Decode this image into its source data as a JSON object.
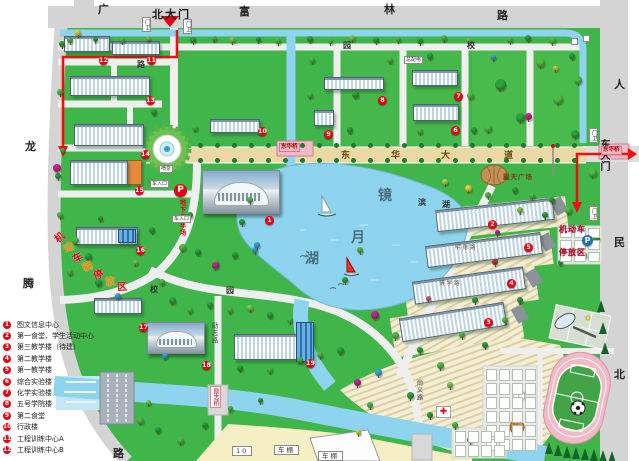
{
  "gates": {
    "north": "北大门",
    "east": "东大门"
  },
  "plaza": {
    "name": "露天广场"
  },
  "parking": {
    "underground": {
      "p": "P",
      "name": "地下停车场"
    },
    "motor": {
      "p": "P",
      "line1": "机动车",
      "line2": "停放区"
    }
  },
  "icons": {
    "medical_cross": "✚"
  },
  "zone_arc": {
    "text": "机动车辆停放区",
    "chars": [
      {
        "t": "机",
        "x": 54,
        "y": 229,
        "r": -40,
        "c": "#e60012"
      },
      {
        "t": "动",
        "x": 63,
        "y": 239,
        "r": -34,
        "c": "#f08300"
      },
      {
        "t": "车",
        "x": 72,
        "y": 249,
        "r": -28,
        "c": "#e60012"
      },
      {
        "t": "辆",
        "x": 82,
        "y": 258,
        "r": -22,
        "c": "#f08300"
      },
      {
        "t": "停",
        "x": 93,
        "y": 266,
        "r": -16,
        "c": "#e60012"
      },
      {
        "t": "放",
        "x": 105,
        "y": 273,
        "r": -10,
        "c": "#f08300"
      },
      {
        "t": "区",
        "x": 117,
        "y": 278,
        "r": -4,
        "c": "#e60012"
      }
    ]
  },
  "lake": {
    "chars": [
      {
        "t": "镜",
        "x": 378,
        "y": 185
      },
      {
        "t": "月",
        "x": 351,
        "y": 227
      },
      {
        "t": "湖",
        "x": 305,
        "y": 248
      }
    ]
  },
  "bridges": [
    {
      "name": "东华桥",
      "x": 279,
      "y": 143
    },
    {
      "name": "东华桥",
      "x": 601,
      "y": 146
    }
  ],
  "legend": {
    "items": [
      {
        "num": "1",
        "label": "图文信息中心"
      },
      {
        "num": "2",
        "label": "第一食堂、学生活动中心"
      },
      {
        "num": "3",
        "label": "第三教学楼（待建）"
      },
      {
        "num": "4",
        "label": "第二教学楼"
      },
      {
        "num": "5",
        "label": "第一教学楼"
      },
      {
        "num": "6",
        "label": "综合实验楼"
      },
      {
        "num": "7",
        "label": "化学实验楼"
      },
      {
        "num": "8",
        "label": "五号学院楼"
      },
      {
        "num": "9",
        "label": "第二食堂"
      },
      {
        "num": "10",
        "label": "行政楼"
      },
      {
        "num": "11",
        "label": "工程训练中心A"
      },
      {
        "num": "12",
        "label": "工程训练中心B"
      }
    ]
  },
  "markers": {
    "circles": [
      {
        "n": "1",
        "x": 265,
        "y": 216
      },
      {
        "n": "2",
        "x": 488,
        "y": 220
      },
      {
        "n": "3",
        "x": 484,
        "y": 318
      },
      {
        "n": "4",
        "x": 507,
        "y": 279
      },
      {
        "n": "5",
        "x": 524,
        "y": 243
      },
      {
        "n": "6",
        "x": 451,
        "y": 126
      },
      {
        "n": "7",
        "x": 454,
        "y": 92
      },
      {
        "n": "8",
        "x": 378,
        "y": 96
      },
      {
        "n": "9",
        "x": 324,
        "y": 130
      },
      {
        "n": "10",
        "x": 258,
        "y": 127
      },
      {
        "n": "11",
        "x": 147,
        "y": 56
      },
      {
        "n": "12",
        "x": 99,
        "y": 56
      },
      {
        "n": "13",
        "x": 146,
        "y": 96
      },
      {
        "n": "14",
        "x": 141,
        "y": 150
      },
      {
        "n": "15",
        "x": 135,
        "y": 186
      },
      {
        "n": "16",
        "x": 136,
        "y": 246
      },
      {
        "n": "17",
        "x": 139,
        "y": 323
      },
      {
        "n": "18",
        "x": 202,
        "y": 361
      },
      {
        "n": "19",
        "x": 306,
        "y": 359
      }
    ]
  },
  "road_chars": [
    {
      "t": "广",
      "x": 98,
      "y": 1,
      "cls": "big"
    },
    {
      "t": "富",
      "x": 239,
      "y": 3,
      "cls": "big"
    },
    {
      "t": "林",
      "x": 384,
      "y": 1,
      "cls": "big"
    },
    {
      "t": "路",
      "x": 497,
      "y": 7,
      "cls": "big"
    },
    {
      "t": "人",
      "x": 614,
      "y": 76,
      "cls": "big"
    },
    {
      "t": "民",
      "x": 614,
      "y": 234,
      "cls": "big"
    },
    {
      "t": "北",
      "x": 614,
      "y": 366,
      "cls": "big"
    },
    {
      "t": "龙",
      "x": 25,
      "y": 138,
      "cls": "big"
    },
    {
      "t": "腾",
      "x": 23,
      "y": 275,
      "cls": "big"
    },
    {
      "t": "路",
      "x": 113,
      "y": 445,
      "cls": "big"
    },
    {
      "t": "园",
      "x": 343,
      "y": 40,
      "cls": "small"
    },
    {
      "t": "校",
      "x": 467,
      "y": 40,
      "cls": "small"
    },
    {
      "t": "路",
      "x": 137,
      "y": 59,
      "cls": "small"
    },
    {
      "t": "校",
      "x": 150,
      "y": 284,
      "cls": "small"
    },
    {
      "t": "园",
      "x": 226,
      "y": 285,
      "cls": "small"
    },
    {
      "t": "滨",
      "x": 418,
      "y": 197,
      "cls": "small"
    },
    {
      "t": "湖",
      "x": 442,
      "y": 199,
      "cls": "small"
    },
    {
      "t": "东",
      "x": 341,
      "y": 148,
      "cls": "blvd"
    },
    {
      "t": "华",
      "x": 391,
      "y": 148,
      "cls": "blvd"
    },
    {
      "t": "大",
      "x": 441,
      "y": 148,
      "cls": "blvd"
    },
    {
      "t": "道",
      "x": 504,
      "y": 148,
      "cls": "blvd"
    },
    {
      "t": "励志路",
      "x": 209,
      "y": 322,
      "cls": "vert"
    },
    {
      "t": "励志桥",
      "x": 210,
      "y": 386,
      "cls": "vertred"
    },
    {
      "t": "尚义路",
      "x": 414,
      "y": 379,
      "cls": "vert"
    },
    {
      "t": "明德路",
      "x": 455,
      "y": 243,
      "cls": "tinypath"
    },
    {
      "t": "博学路",
      "x": 439,
      "y": 279,
      "cls": "tinypath"
    }
  ],
  "boxes": [
    {
      "t": "门卫",
      "x": 142,
      "y": 17,
      "vert": true
    },
    {
      "t": "门卫",
      "x": 183,
      "y": 19,
      "vert": true
    },
    {
      "t": "门卫",
      "x": 589,
      "y": 128,
      "vert": true
    },
    {
      "t": "门卫",
      "x": 589,
      "y": 206,
      "vert": true
    },
    {
      "t": "车入口",
      "x": 150,
      "y": 180
    },
    {
      "t": "车入口",
      "x": 172,
      "y": 215
    },
    {
      "t": "总配电",
      "x": 404,
      "y": 56
    },
    {
      "t": "喷泉",
      "x": 159,
      "y": 165
    },
    {
      "t": "",
      "x": 571,
      "y": 38
    },
    {
      "t": "",
      "x": 583,
      "y": 35
    },
    {
      "t": "10",
      "x": 232,
      "y": 446,
      "wide": true
    },
    {
      "t": "车棚",
      "x": 274,
      "y": 445,
      "wide": true
    },
    {
      "t": "车棚",
      "x": 318,
      "y": 451,
      "wide": true
    }
  ],
  "colors": {
    "grass": "#3fb54a",
    "water": "#8fd4ee",
    "road": "#d4d4d4",
    "inner_road": "#efefef",
    "boulevard": "#ead9a5",
    "sand": "#f6efc3",
    "marker_red": "#e60012",
    "route_red": "#f01010",
    "track_pink": "#f3b9c4",
    "field_green": "#43a447"
  },
  "decor": {
    "tree_palette": [
      "#17862f",
      "#2ea33c",
      "#4fbd45",
      "#7bcf52",
      "#a9dc4e",
      "#e3cf3a",
      "#c2268e",
      "#7e2b95",
      "#36a6da",
      "#d4608a",
      "#b23737"
    ],
    "trees": [
      [
        70,
        40,
        6,
        2
      ],
      [
        78,
        33,
        6,
        5
      ],
      [
        95,
        39,
        5,
        1
      ],
      [
        122,
        40,
        6,
        2
      ],
      [
        148,
        38,
        5,
        3
      ],
      [
        193,
        40,
        6,
        1
      ],
      [
        214,
        38,
        5,
        2
      ],
      [
        232,
        40,
        6,
        3
      ],
      [
        258,
        39,
        5,
        1
      ],
      [
        278,
        41,
        6,
        2
      ],
      [
        310,
        39,
        6,
        1
      ],
      [
        330,
        41,
        5,
        2
      ],
      [
        352,
        38,
        6,
        3
      ],
      [
        376,
        40,
        6,
        1
      ],
      [
        398,
        39,
        5,
        2
      ],
      [
        420,
        41,
        6,
        1
      ],
      [
        444,
        38,
        6,
        2
      ],
      [
        468,
        40,
        5,
        3
      ],
      [
        493,
        57,
        5,
        8
      ],
      [
        510,
        40,
        6,
        2
      ],
      [
        528,
        38,
        6,
        1
      ],
      [
        552,
        40,
        7,
        2
      ],
      [
        572,
        56,
        6,
        1
      ],
      [
        500,
        84,
        11,
        1
      ],
      [
        540,
        62,
        9,
        2
      ],
      [
        520,
        117,
        9,
        1
      ],
      [
        558,
        99,
        10,
        2
      ],
      [
        575,
        134,
        8,
        1
      ],
      [
        488,
        128,
        8,
        2
      ],
      [
        555,
        68,
        5,
        5
      ],
      [
        528,
        116,
        7,
        6
      ],
      [
        578,
        80,
        8,
        2
      ],
      [
        592,
        172,
        9,
        2
      ],
      [
        312,
        60,
        6,
        2
      ],
      [
        355,
        94,
        7,
        1
      ],
      [
        390,
        60,
        6,
        2
      ],
      [
        430,
        56,
        6,
        1
      ],
      [
        470,
        95,
        7,
        2
      ],
      [
        474,
        130,
        6,
        1
      ],
      [
        420,
        131,
        6,
        2
      ],
      [
        350,
        130,
        6,
        1
      ],
      [
        310,
        95,
        6,
        2
      ],
      [
        62,
        44,
        6,
        1
      ],
      [
        60,
        92,
        6,
        2
      ],
      [
        154,
        112,
        6,
        1
      ],
      [
        62,
        150,
        5,
        2
      ],
      [
        58,
        176,
        6,
        1
      ],
      [
        150,
        180,
        5,
        2
      ],
      [
        60,
        215,
        6,
        2
      ],
      [
        100,
        218,
        5,
        1
      ],
      [
        75,
        240,
        7,
        2
      ],
      [
        88,
        256,
        7,
        1
      ],
      [
        70,
        272,
        6,
        2
      ],
      [
        98,
        282,
        7,
        1
      ],
      [
        118,
        296,
        6,
        8
      ],
      [
        135,
        262,
        5,
        3
      ],
      [
        195,
        128,
        6,
        2
      ],
      [
        190,
        215,
        6,
        1
      ],
      [
        182,
        247,
        7,
        2
      ],
      [
        198,
        252,
        6,
        1
      ],
      [
        215,
        262,
        7,
        2
      ],
      [
        235,
        255,
        6,
        1
      ],
      [
        255,
        250,
        6,
        8
      ],
      [
        57,
        168,
        8,
        6
      ],
      [
        152,
        230,
        6,
        1
      ],
      [
        250,
        200,
        6,
        2
      ],
      [
        242,
        222,
        6,
        1
      ],
      [
        257,
        245,
        6,
        8
      ],
      [
        215,
        265,
        7,
        6
      ],
      [
        162,
        282,
        6,
        2
      ],
      [
        172,
        300,
        7,
        1
      ],
      [
        190,
        310,
        6,
        2
      ],
      [
        210,
        305,
        6,
        1
      ],
      [
        230,
        310,
        6,
        2
      ],
      [
        250,
        308,
        6,
        3
      ],
      [
        270,
        315,
        6,
        1
      ],
      [
        290,
        320,
        6,
        2
      ],
      [
        445,
        182,
        6,
        4
      ],
      [
        468,
        188,
        7,
        5
      ],
      [
        488,
        195,
        6,
        2
      ],
      [
        515,
        190,
        6,
        1
      ],
      [
        532,
        196,
        6,
        2
      ],
      [
        552,
        200,
        6,
        1
      ],
      [
        568,
        210,
        7,
        2
      ],
      [
        545,
        215,
        6,
        1
      ],
      [
        520,
        210,
        6,
        3
      ],
      [
        584,
        255,
        6,
        2
      ],
      [
        560,
        262,
        5,
        1
      ],
      [
        596,
        238,
        7,
        1
      ],
      [
        375,
        315,
        8,
        6
      ],
      [
        378,
        372,
        7,
        8
      ],
      [
        357,
        382,
        7,
        6
      ],
      [
        340,
        350,
        7,
        1
      ],
      [
        320,
        355,
        6,
        2
      ],
      [
        360,
        250,
        6,
        2
      ],
      [
        345,
        280,
        6,
        1
      ],
      [
        395,
        335,
        7,
        2
      ],
      [
        420,
        350,
        6,
        1
      ],
      [
        440,
        365,
        7,
        2
      ],
      [
        410,
        395,
        7,
        1
      ],
      [
        370,
        405,
        6,
        2
      ],
      [
        430,
        415,
        6,
        1
      ],
      [
        455,
        425,
        6,
        2
      ],
      [
        475,
        300,
        6,
        1
      ],
      [
        497,
        232,
        5,
        6
      ],
      [
        495,
        262,
        6,
        10
      ],
      [
        462,
        335,
        6,
        2
      ],
      [
        485,
        345,
        6,
        1
      ],
      [
        505,
        320,
        6,
        2
      ],
      [
        520,
        300,
        6,
        1
      ],
      [
        450,
        385,
        6,
        3
      ],
      [
        358,
        432,
        5,
        5
      ],
      [
        428,
        298,
        5,
        9
      ],
      [
        140,
        420,
        7,
        2
      ],
      [
        158,
        430,
        6,
        1
      ],
      [
        180,
        440,
        7,
        2
      ],
      [
        205,
        425,
        6,
        1
      ],
      [
        148,
        402,
        5,
        3
      ],
      [
        230,
        408,
        5,
        2
      ],
      [
        260,
        400,
        5,
        1
      ],
      [
        270,
        370,
        6,
        2
      ],
      [
        240,
        368,
        6,
        1
      ],
      [
        300,
        360,
        6,
        2
      ],
      [
        470,
        440,
        6,
        1
      ],
      [
        485,
        452,
        5,
        2
      ],
      [
        165,
        356,
        6,
        8
      ]
    ],
    "pines": [
      [
        545,
        442
      ],
      [
        554,
        444
      ],
      [
        563,
        446
      ],
      [
        572,
        447
      ],
      [
        581,
        448
      ],
      [
        590,
        449
      ],
      [
        599,
        450
      ],
      [
        608,
        451
      ],
      [
        597,
        300
      ],
      [
        599,
        322
      ],
      [
        601,
        342
      ]
    ]
  }
}
